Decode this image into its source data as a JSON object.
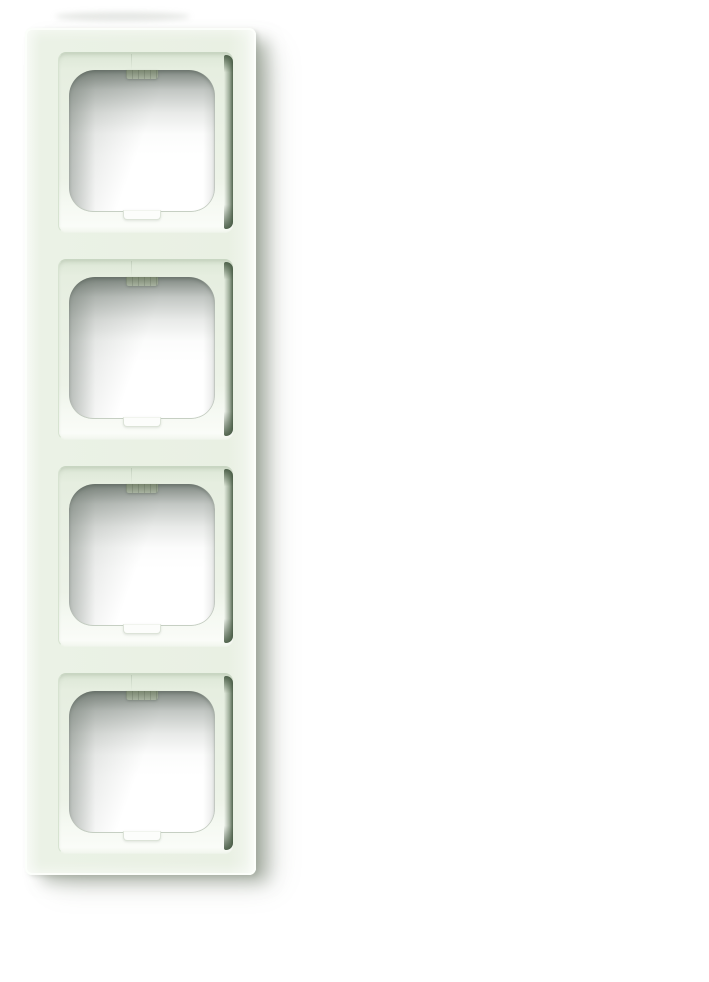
{
  "scene": {
    "subject": "product-photo-of-four-gang-switch-frame",
    "frame": {
      "module_count": 4
    },
    "theme": {
      "bg": "#ffffff",
      "face": "#eaf1e5",
      "recess-top-line": "#c8d6c2",
      "recess-left-line": "#d7e3d1",
      "recess-top-shadow": "rgba(150,165,143,0.45)",
      "channel-mid": "rgba(98,118,94,0.55)",
      "channel-dark": "rgba(66,86,63,0.9)",
      "hole-shadow": "rgba(104,114,106,0.85)",
      "hole-side-shadow": "rgba(120,130,122,0.4)",
      "hole-bottom-line": "rgba(195,205,192,0.9)",
      "tab-dark": "#79866f",
      "tab-light": "#a8b2a0",
      "notch-fill": "#fcfdfb",
      "notch-line": "#dce3d8",
      "drop-shadow": "rgba(128,138,122,0.55)",
      "drop-shadow-soft": "rgba(128,138,122,0.32)",
      "ambient": "rgba(150,160,148,0.25)"
    }
  }
}
